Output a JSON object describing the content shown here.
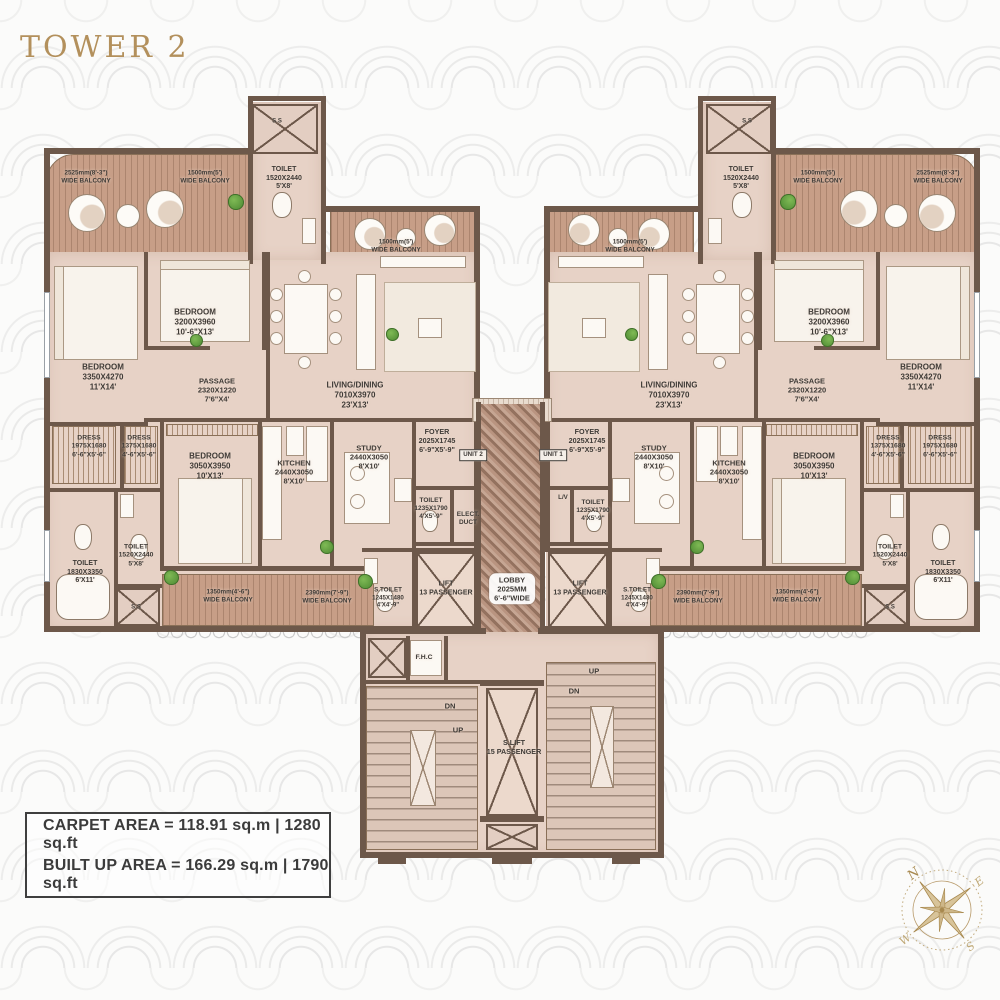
{
  "title": "TOWER 2",
  "area_info": {
    "carpet": "CARPET AREA = 118.91 sq.m | 1280 sq.ft",
    "built": "BUILT UP AREA = 166.29 sq.m | 1790 sq.ft"
  },
  "compass": {
    "n": "N",
    "e": "E",
    "s": "S",
    "w": "W"
  },
  "colors": {
    "wall": "#6d584a",
    "room_floor": "#e7d2c6",
    "balcony_floor": "#c79e87",
    "accent_gold": "#b3905c",
    "label_text": "#3e3a36"
  },
  "plan": {
    "labels": [
      {
        "t": [
          "2525mm(8'-3\")",
          "WIDE BALCONY"
        ],
        "x": 86,
        "y": 177,
        "fs": 6.3,
        "n": "balcony-label"
      },
      {
        "t": [
          "1500mm(5')",
          "WIDE BALCONY"
        ],
        "x": 205,
        "y": 177,
        "fs": 6.3,
        "n": "balcony-label"
      },
      {
        "t": [
          "S.S"
        ],
        "x": 277,
        "y": 122,
        "fs": 6,
        "n": "shaft-label"
      },
      {
        "t": [
          "TOILET",
          "1520X2440",
          "5'X8'"
        ],
        "x": 284,
        "y": 179,
        "fs": 7,
        "n": "toilet-label"
      },
      {
        "t": [
          "1500mm(5')",
          "WIDE BALCONY"
        ],
        "x": 396,
        "y": 246,
        "fs": 6.3,
        "n": "balcony-label"
      },
      {
        "t": [
          "BEDROOM",
          "3200X3960",
          "10'-6\"X13'"
        ],
        "x": 195,
        "y": 322,
        "fs": 8,
        "n": "bedroom-label"
      },
      {
        "t": [
          "BEDROOM",
          "3350X4270",
          "11'X14'"
        ],
        "x": 103,
        "y": 377,
        "fs": 8,
        "n": "bedroom-label"
      },
      {
        "t": [
          "PASSAGE",
          "2320X1220",
          "7'6\"X4'"
        ],
        "x": 217,
        "y": 390,
        "fs": 7.5,
        "n": "passage-label"
      },
      {
        "t": [
          "LIVING/DINING",
          "7010X3970",
          "23'X13'"
        ],
        "x": 355,
        "y": 395,
        "fs": 8,
        "n": "living-dining-label"
      },
      {
        "t": [
          "DRESS",
          "1975X1680",
          "6'-6\"X5'-6\""
        ],
        "x": 89,
        "y": 447,
        "fs": 6.8,
        "n": "dress-label"
      },
      {
        "t": [
          "DRESS",
          "1375X1680",
          "4'-6\"X5'-6\""
        ],
        "x": 139,
        "y": 447,
        "fs": 6.8,
        "n": "dress-label"
      },
      {
        "t": [
          "BEDROOM",
          "3050X3950",
          "10'X13'"
        ],
        "x": 210,
        "y": 466,
        "fs": 8,
        "n": "bedroom-label"
      },
      {
        "t": [
          "KITCHEN",
          "2440X3050",
          "8'X10'"
        ],
        "x": 294,
        "y": 472,
        "fs": 7.5,
        "n": "kitchen-label"
      },
      {
        "t": [
          "STUDY",
          "2440X3050",
          "8'X10'"
        ],
        "x": 369,
        "y": 457,
        "fs": 7.5,
        "n": "study-label"
      },
      {
        "t": [
          "FOYER",
          "2025X1745",
          "6'-9\"X5'-9\""
        ],
        "x": 437,
        "y": 441,
        "fs": 7.2,
        "n": "foyer-label"
      },
      {
        "t": [
          "UNIT 2"
        ],
        "x": 473,
        "y": 455,
        "fs": 6.2,
        "cls": "boxed",
        "n": "unit-2-tag"
      },
      {
        "t": [
          "TOILET",
          "1235X1790",
          "4'X5'-9\""
        ],
        "x": 431,
        "y": 509,
        "fs": 6.5,
        "n": "toilet-label"
      },
      {
        "t": [
          "ELECT.",
          "DUCT"
        ],
        "x": 468,
        "y": 519,
        "fs": 6.5,
        "n": "elect-duct-label"
      },
      {
        "t": [
          "TOILET",
          "1830X3350",
          "6'X11'"
        ],
        "x": 85,
        "y": 573,
        "fs": 7,
        "n": "toilet-label"
      },
      {
        "t": [
          "TOILET",
          "1520X2440",
          "5'X8'"
        ],
        "x": 136,
        "y": 556,
        "fs": 6.8,
        "n": "toilet-label"
      },
      {
        "t": [
          "S.S"
        ],
        "x": 136,
        "y": 608,
        "fs": 6,
        "n": "shaft-label"
      },
      {
        "t": [
          "1350mm(4'-6\")",
          "WIDE BALCONY"
        ],
        "x": 228,
        "y": 596,
        "fs": 6.3,
        "n": "balcony-label"
      },
      {
        "t": [
          "2390mm(7'-9\")",
          "WIDE BALCONY"
        ],
        "x": 327,
        "y": 597,
        "fs": 6.3,
        "n": "balcony-label"
      },
      {
        "t": [
          "S.TOILET",
          "1245X1480",
          "4'X4'-9\""
        ],
        "x": 388,
        "y": 598,
        "fs": 6.2,
        "n": "toilet-label"
      },
      {
        "t": [
          "LIFT",
          "13 PASSENGER"
        ],
        "x": 446,
        "y": 589,
        "fs": 7,
        "n": "lift-label"
      },
      {
        "t": [
          "LOBBY",
          "2025MM",
          "6'-6\"WIDE"
        ],
        "x": 512,
        "y": 589,
        "fs": 7.5,
        "cls": "lobbybox",
        "n": "lobby-label"
      },
      {
        "t": [
          "F.H.C"
        ],
        "x": 424,
        "y": 658,
        "fs": 6.8,
        "n": "fhc-label"
      },
      {
        "t": [
          "DN"
        ],
        "x": 450,
        "y": 706,
        "fs": 7.5,
        "n": "stair-dn-label"
      },
      {
        "t": [
          "UP"
        ],
        "x": 458,
        "y": 730,
        "fs": 7.5,
        "n": "stair-up-label"
      },
      {
        "t": [
          "S.LIFT",
          "15 PASSENGER"
        ],
        "x": 514,
        "y": 748,
        "fs": 7.2,
        "n": "service-lift-label"
      },
      {
        "t": [
          "DN"
        ],
        "x": 574,
        "y": 691,
        "fs": 7.5,
        "n": "stair-dn-label"
      },
      {
        "t": [
          "UP"
        ],
        "x": 594,
        "y": 671,
        "fs": 7.5,
        "n": "stair-up-label"
      },
      {
        "t": [
          "1500mm(5')",
          "WIDE BALCONY"
        ],
        "x": 630,
        "y": 246,
        "fs": 6.3,
        "n": "balcony-label"
      },
      {
        "t": [
          "S.S"
        ],
        "x": 747,
        "y": 122,
        "fs": 6,
        "n": "shaft-label"
      },
      {
        "t": [
          "TOILET",
          "1520X2440",
          "5'X8'"
        ],
        "x": 741,
        "y": 179,
        "fs": 7,
        "n": "toilet-label"
      },
      {
        "t": [
          "1500mm(5')",
          "WIDE BALCONY"
        ],
        "x": 818,
        "y": 177,
        "fs": 6.3,
        "n": "balcony-label"
      },
      {
        "t": [
          "2525mm(8'-3\")",
          "WIDE BALCONY"
        ],
        "x": 938,
        "y": 177,
        "fs": 6.3,
        "n": "balcony-label"
      },
      {
        "t": [
          "BEDROOM",
          "3200X3960",
          "10'-6\"X13'"
        ],
        "x": 829,
        "y": 322,
        "fs": 8,
        "n": "bedroom-label"
      },
      {
        "t": [
          "BEDROOM",
          "3350X4270",
          "11'X14'"
        ],
        "x": 921,
        "y": 377,
        "fs": 8,
        "n": "bedroom-label"
      },
      {
        "t": [
          "PASSAGE",
          "2320X1220",
          "7'6\"X4'"
        ],
        "x": 807,
        "y": 390,
        "fs": 7.5,
        "n": "passage-label"
      },
      {
        "t": [
          "LIVING/DINING",
          "7010X3970",
          "23'X13'"
        ],
        "x": 669,
        "y": 395,
        "fs": 8,
        "n": "living-dining-label"
      },
      {
        "t": [
          "FOYER",
          "2025X1745",
          "6'-9\"X5'-9\""
        ],
        "x": 587,
        "y": 441,
        "fs": 7.2,
        "n": "foyer-label"
      },
      {
        "t": [
          "UNIT 1"
        ],
        "x": 553,
        "y": 455,
        "fs": 6.2,
        "cls": "boxed",
        "n": "unit-1-tag"
      },
      {
        "t": [
          "STUDY",
          "2440X3050",
          "8'X10'"
        ],
        "x": 654,
        "y": 457,
        "fs": 7.5,
        "n": "study-label"
      },
      {
        "t": [
          "KITCHEN",
          "2440X3050",
          "8'X10'"
        ],
        "x": 729,
        "y": 472,
        "fs": 7.5,
        "n": "kitchen-label"
      },
      {
        "t": [
          "L/V"
        ],
        "x": 563,
        "y": 498,
        "fs": 6.2,
        "n": "lv-label"
      },
      {
        "t": [
          "TOILET",
          "1235X1790",
          "4'X5'-9\""
        ],
        "x": 593,
        "y": 511,
        "fs": 6.5,
        "n": "toilet-label"
      },
      {
        "t": [
          "BEDROOM",
          "3050X3950",
          "10'X13'"
        ],
        "x": 814,
        "y": 466,
        "fs": 8,
        "n": "bedroom-label"
      },
      {
        "t": [
          "DRESS",
          "1375X1680",
          "4'-6\"X5'-6\""
        ],
        "x": 888,
        "y": 447,
        "fs": 6.8,
        "n": "dress-label"
      },
      {
        "t": [
          "DRESS",
          "1975X1680",
          "6'-6\"X5'-6\""
        ],
        "x": 940,
        "y": 447,
        "fs": 6.8,
        "n": "dress-label"
      },
      {
        "t": [
          "TOILET",
          "1520X2440",
          "5'X8'"
        ],
        "x": 890,
        "y": 556,
        "fs": 6.8,
        "n": "toilet-label"
      },
      {
        "t": [
          "TOILET",
          "1830X3350",
          "6'X11'"
        ],
        "x": 943,
        "y": 573,
        "fs": 7,
        "n": "toilet-label"
      },
      {
        "t": [
          "S.S"
        ],
        "x": 890,
        "y": 608,
        "fs": 6,
        "n": "shaft-label"
      },
      {
        "t": [
          "2390mm(7'-9\")",
          "WIDE BALCONY"
        ],
        "x": 698,
        "y": 597,
        "fs": 6.3,
        "n": "balcony-label"
      },
      {
        "t": [
          "1350mm(4'-6\")",
          "WIDE BALCONY"
        ],
        "x": 797,
        "y": 596,
        "fs": 6.3,
        "n": "balcony-label"
      },
      {
        "t": [
          "S.TOILET",
          "1245X1480",
          "4'X4'-9\""
        ],
        "x": 637,
        "y": 598,
        "fs": 6.2,
        "n": "toilet-label"
      },
      {
        "t": [
          "LIFT",
          "13 PASSENGER"
        ],
        "x": 580,
        "y": 589,
        "fs": 7,
        "n": "lift-label"
      }
    ]
  }
}
